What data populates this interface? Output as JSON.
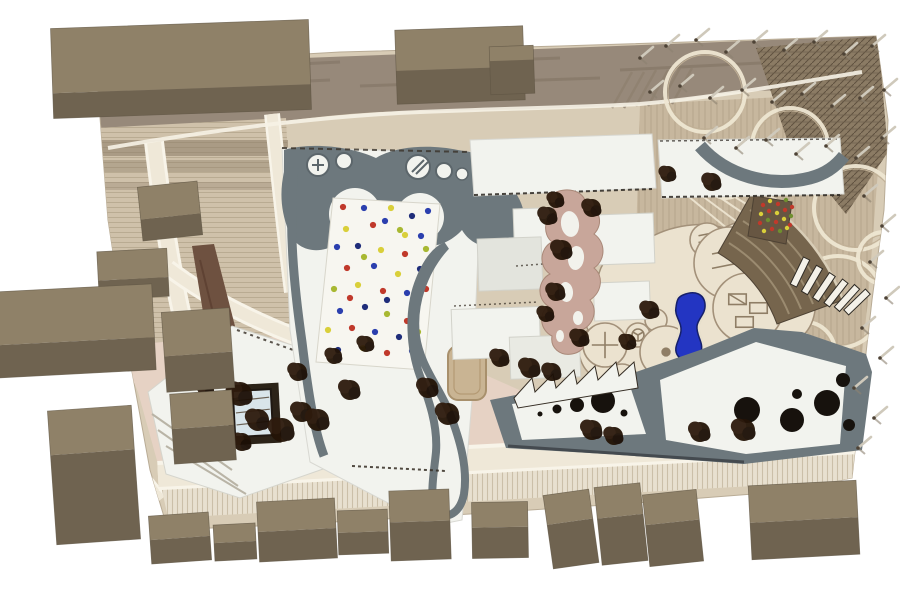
{
  "scene_label": "aerial-photo-of-cardboard-architecture-site-model",
  "colors": {
    "background": "#ffffff",
    "base_wood": "#d8ccb6",
    "road_top": "#97897a",
    "road_top_streak": "#7b6e5d",
    "stripe_area": "#cfc1aa",
    "stripe_line": "#b9ab92",
    "dark_row": "#8c7c66",
    "wood_right": "#c7b79e",
    "wood_line": "#b2a188",
    "hatch": "#8b7b64",
    "hatch_line": "#5f5140",
    "plaza_pink": "#e6d2c4",
    "road_cream": "#efe8d8",
    "curb_white": "#f8f4e9",
    "walnut": "#6e5140",
    "roof_white": "#f2f3ee",
    "roof_shadow": "#e3e4dd",
    "path_gray": "#6d787d",
    "edge_dark": "#352d24",
    "terrace_rose": "#c8a69a",
    "play_cream": "#ebe2cf",
    "play_line": "#a3917a",
    "pool_blue": "#2335c2",
    "pool_edge": "#16206b",
    "amphi": "#76654d",
    "amphi_line": "#9b8b70",
    "patch_brown": "#675642",
    "ramp_white": "#f4f1e8",
    "block_top": "#8f8168",
    "block_front": "#6f6350",
    "block_edge": "#5e5443",
    "tree_dark": "#241407",
    "peg_light": "#cfc9bb",
    "peg_shadow": "#8d8271",
    "skylight": "#d9e5ea",
    "courtyard_frame": "#2c2318",
    "hole_black": "#17120d",
    "dot_palette": [
      "#c0392b",
      "#2b3fae",
      "#1f2d7a",
      "#d9cf3a",
      "#a8b832"
    ],
    "climb_palette": [
      "#c0392b",
      "#d9cf3a",
      "#6f8f2f"
    ]
  },
  "scene": {
    "blocks": [
      [
        52,
        24,
        258,
        90,
        -2,
        0.72
      ],
      [
        396,
        28,
        128,
        74,
        -2,
        0.55
      ],
      [
        490,
        46,
        44,
        48,
        -2,
        0.3
      ],
      [
        140,
        184,
        60,
        54,
        -6,
        0.6
      ],
      [
        98,
        250,
        70,
        48,
        -3,
        0.6
      ],
      [
        -8,
        288,
        162,
        86,
        -3,
        0.62
      ],
      [
        164,
        310,
        68,
        80,
        -4,
        0.55
      ],
      [
        172,
        392,
        62,
        70,
        -4,
        0.5
      ],
      [
        52,
        408,
        84,
        134,
        -4,
        0.33
      ],
      [
        150,
        514,
        60,
        48,
        -4,
        0.5
      ],
      [
        214,
        524,
        42,
        36,
        -3,
        0.5
      ],
      [
        258,
        500,
        78,
        60,
        -3,
        0.5
      ],
      [
        338,
        510,
        50,
        44,
        -2,
        0.5
      ],
      [
        390,
        490,
        60,
        70,
        -2,
        0.45
      ],
      [
        472,
        502,
        56,
        56,
        -1,
        0.45
      ],
      [
        548,
        492,
        46,
        74,
        -8,
        0.4
      ],
      [
        598,
        485,
        46,
        78,
        -6,
        0.4
      ],
      [
        646,
        492,
        54,
        72,
        -6,
        0.42
      ],
      [
        750,
        483,
        108,
        74,
        -3,
        0.5
      ]
    ],
    "trees": [
      [
        222,
        368,
        10
      ],
      [
        240,
        394,
        12
      ],
      [
        258,
        420,
        11
      ],
      [
        242,
        442,
        9
      ],
      [
        282,
        430,
        12
      ],
      [
        302,
        412,
        10
      ],
      [
        298,
        372,
        9
      ],
      [
        318,
        420,
        11
      ],
      [
        334,
        356,
        8
      ],
      [
        350,
        390,
        10
      ],
      [
        206,
        390,
        8
      ],
      [
        366,
        344,
        8
      ],
      [
        428,
        388,
        10
      ],
      [
        448,
        414,
        11
      ],
      [
        500,
        358,
        9
      ],
      [
        530,
        368,
        10
      ],
      [
        552,
        372,
        9
      ],
      [
        548,
        216,
        9
      ],
      [
        562,
        250,
        10
      ],
      [
        556,
        292,
        9
      ],
      [
        546,
        314,
        8
      ],
      [
        580,
        338,
        9
      ],
      [
        592,
        430,
        10
      ],
      [
        614,
        436,
        9
      ],
      [
        700,
        432,
        10
      ],
      [
        744,
        430,
        11
      ],
      [
        650,
        310,
        9
      ],
      [
        628,
        342,
        8
      ],
      [
        556,
        200,
        8
      ],
      [
        592,
        208,
        9
      ],
      [
        668,
        174,
        8
      ],
      [
        712,
        182,
        9
      ]
    ],
    "pegs": [
      [
        640,
        58
      ],
      [
        666,
        46
      ],
      [
        696,
        40
      ],
      [
        726,
        52
      ],
      [
        754,
        42
      ],
      [
        784,
        50
      ],
      [
        814,
        42
      ],
      [
        844,
        54
      ],
      [
        872,
        46
      ],
      [
        650,
        92
      ],
      [
        680,
        86
      ],
      [
        710,
        98
      ],
      [
        742,
        90
      ],
      [
        772,
        102
      ],
      [
        802,
        94
      ],
      [
        832,
        106
      ],
      [
        860,
        98
      ],
      [
        884,
        90
      ],
      [
        704,
        138
      ],
      [
        736,
        148
      ],
      [
        766,
        140
      ],
      [
        796,
        154
      ],
      [
        826,
        146
      ],
      [
        856,
        158
      ],
      [
        882,
        138
      ],
      [
        864,
        196
      ],
      [
        882,
        226
      ],
      [
        870,
        262
      ],
      [
        886,
        298
      ],
      [
        862,
        328
      ],
      [
        880,
        358
      ],
      [
        854,
        388
      ],
      [
        874,
        418
      ],
      [
        858,
        448
      ]
    ],
    "confetti_dots": [
      [
        343,
        207,
        0
      ],
      [
        364,
        208,
        1
      ],
      [
        391,
        208,
        3
      ],
      [
        412,
        216,
        2
      ],
      [
        428,
        211,
        1
      ],
      [
        346,
        229,
        3
      ],
      [
        373,
        225,
        0
      ],
      [
        400,
        230,
        4
      ],
      [
        421,
        236,
        1
      ],
      [
        337,
        247,
        1
      ],
      [
        358,
        246,
        2
      ],
      [
        381,
        250,
        3
      ],
      [
        405,
        254,
        0
      ],
      [
        426,
        249,
        4
      ],
      [
        347,
        268,
        0
      ],
      [
        374,
        266,
        1
      ],
      [
        398,
        274,
        3
      ],
      [
        420,
        269,
        2
      ],
      [
        334,
        289,
        4
      ],
      [
        358,
        285,
        3
      ],
      [
        383,
        291,
        0
      ],
      [
        407,
        293,
        1
      ],
      [
        426,
        289,
        0
      ],
      [
        340,
        311,
        1
      ],
      [
        365,
        307,
        2
      ],
      [
        387,
        314,
        4
      ],
      [
        413,
        311,
        3
      ],
      [
        328,
        330,
        3
      ],
      [
        352,
        328,
        0
      ],
      [
        375,
        332,
        1
      ],
      [
        399,
        337,
        2
      ],
      [
        418,
        332,
        4
      ],
      [
        338,
        350,
        2
      ],
      [
        363,
        348,
        3
      ],
      [
        387,
        353,
        0
      ],
      [
        412,
        351,
        1
      ],
      [
        385,
        221,
        1
      ],
      [
        387,
        300,
        2
      ],
      [
        350,
        298,
        0
      ],
      [
        405,
        235,
        3
      ],
      [
        364,
        257,
        4
      ],
      [
        407,
        321,
        0
      ]
    ],
    "climb_dots": [
      [
        763,
        205,
        0
      ],
      [
        770,
        201,
        1
      ],
      [
        778,
        204,
        0
      ],
      [
        786,
        200,
        2
      ],
      [
        792,
        207,
        0
      ],
      [
        761,
        214,
        1
      ],
      [
        769,
        211,
        0
      ],
      [
        777,
        213,
        1
      ],
      [
        785,
        210,
        0
      ],
      [
        791,
        216,
        2
      ],
      [
        760,
        223,
        0
      ],
      [
        768,
        220,
        2
      ],
      [
        776,
        222,
        0
      ],
      [
        784,
        219,
        1
      ],
      [
        790,
        225,
        0
      ],
      [
        764,
        231,
        1
      ],
      [
        772,
        229,
        0
      ],
      [
        780,
        231,
        2
      ],
      [
        787,
        228,
        1
      ]
    ],
    "roof_holes": [
      [
        540,
        414,
        2.5
      ],
      [
        557,
        409,
        4.5
      ],
      [
        577,
        405,
        7
      ],
      [
        603,
        401,
        12
      ],
      [
        624,
        413,
        3.5
      ],
      [
        747,
        410,
        13
      ],
      [
        792,
        420,
        12
      ],
      [
        827,
        403,
        13
      ],
      [
        843,
        380,
        7
      ],
      [
        797,
        394,
        5
      ],
      [
        849,
        425,
        6
      ]
    ],
    "canopy_rings": [
      [
        705,
        92,
        40
      ],
      [
        790,
        146,
        38
      ],
      [
        856,
        208,
        42
      ],
      [
        838,
        302,
        46
      ],
      [
        884,
        258,
        26
      ],
      [
        764,
        252,
        28
      ],
      [
        726,
        178,
        20
      ],
      [
        805,
        352,
        30
      ]
    ],
    "play_circles": [
      [
        707,
        240,
        17,
        "bars"
      ],
      [
        730,
        263,
        36,
        "bars"
      ],
      [
        747,
        255,
        12,
        "wheel"
      ],
      [
        748,
        308,
        35,
        "grid"
      ],
      [
        605,
        345,
        22,
        "cross"
      ],
      [
        638,
        335,
        12,
        "wheel"
      ],
      [
        656,
        320,
        11,
        "none"
      ],
      [
        666,
        352,
        26,
        "dot"
      ],
      [
        600,
        302,
        12,
        "none"
      ],
      [
        627,
        305,
        10,
        "none"
      ],
      [
        704,
        385,
        20,
        "none"
      ],
      [
        622,
        380,
        16,
        "dot"
      ]
    ],
    "ramps": [
      [
        800,
        272,
        -64
      ],
      [
        812,
        280,
        -60
      ],
      [
        824,
        287,
        -56
      ],
      [
        836,
        293,
        -52
      ],
      [
        847,
        298,
        -48
      ],
      [
        857,
        302,
        -44
      ]
    ],
    "fan_lines": [
      [
        688,
        196,
        746,
        244
      ],
      [
        697,
        192,
        756,
        236
      ],
      [
        706,
        188,
        765,
        228
      ],
      [
        714,
        184,
        772,
        220
      ],
      [
        721,
        179,
        778,
        211
      ],
      [
        727,
        174,
        783,
        203
      ]
    ]
  }
}
